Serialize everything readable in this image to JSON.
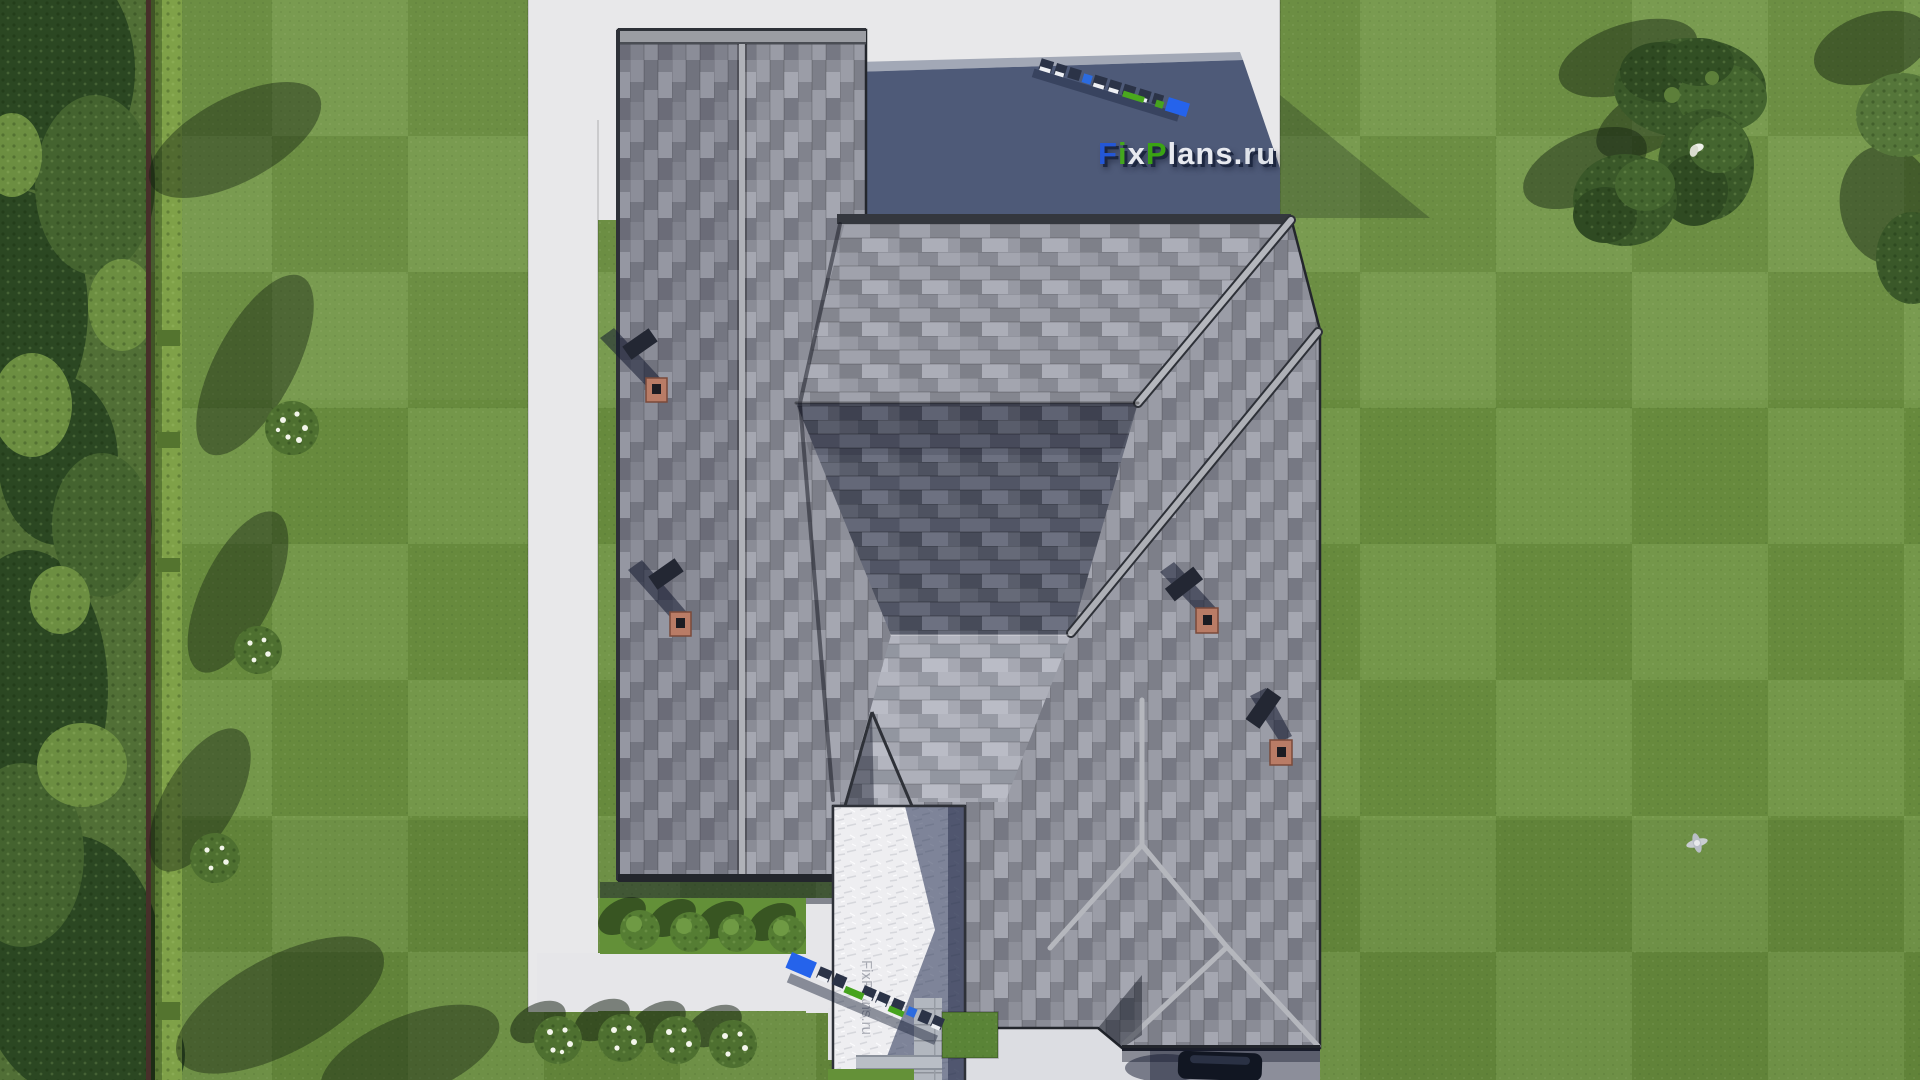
{
  "scene": {
    "description": "Top-down aerial 3D render of a house with gray shingled hip roofs, white concrete paths, lawn, hedges and trees",
    "source_label": "FixPlans.ru"
  },
  "watermark": {
    "text": "FixPlans.ru",
    "shadow_color": "#1d2740",
    "letters": [
      {
        "ch": "F",
        "color": "#2457d6"
      },
      {
        "ch": "i",
        "color": "#44a71d"
      },
      {
        "ch": "x",
        "color": "#e8eaf0"
      },
      {
        "ch": "P",
        "color": "#3aa313"
      },
      {
        "ch": "l",
        "color": "#e8eaf0"
      },
      {
        "ch": "a",
        "color": "#e8eaf0"
      },
      {
        "ch": "n",
        "color": "#e8eaf0"
      },
      {
        "ch": "s",
        "color": "#e8eaf0"
      },
      {
        "ch": ".",
        "color": "#e8eaf0"
      },
      {
        "ch": "r",
        "color": "#dfe3ea"
      },
      {
        "ch": "u",
        "color": "#dfe3ea"
      }
    ]
  },
  "watermark_3d_top": {
    "text": "FixPlans.ru"
  },
  "watermark_3d_bottom": {
    "text": "FixPlans.ru"
  },
  "watermark_path": {
    "text": "FixPlans.ru"
  },
  "palette": {
    "lawn": "#6d9140",
    "roof_base": "#8f919b",
    "roof_dark_plane": "#5a5e6c",
    "roof_light_plane": "#a3a5af",
    "ridge_cap": "#b5b7bd",
    "path_white": "#e8e8ea",
    "shadow_blue": "#4e5a78",
    "hedge": "#7fa148",
    "brick_chimney": "#b97c66",
    "logo_blue": "#2563eb",
    "logo_green": "#46a31e"
  },
  "landscape": {
    "green_bushes_row": 4,
    "flower_bushes_row": 4,
    "lawn_shrubs": 3,
    "tree_clusters_top_right": 3
  }
}
